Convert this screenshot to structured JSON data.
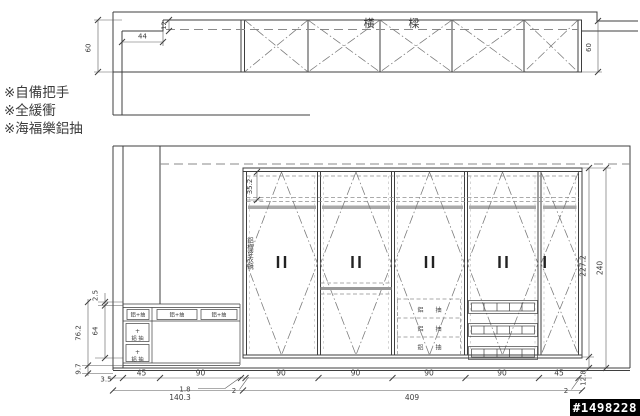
{
  "notes": [
    "※自備把手",
    "※全緩衝",
    "※海福樂鋁抽"
  ],
  "beam_plan": {
    "title": {
      "char1": "橫",
      "char2": "樑"
    },
    "dims": {
      "height_left": "60",
      "height_right": "60",
      "step_width": "44",
      "step_depth": "12"
    }
  },
  "elevation": {
    "dims": {
      "top_shelf_gap": "35.2",
      "body_height": "227.2",
      "total_height": "240",
      "kick_height": "12.8",
      "counter_thickness": "2.5",
      "drawer_col_height": "64",
      "bench_height": "76.2",
      "base_height": "9.7",
      "wall_thickness": "3.5",
      "widths": [
        "45",
        "90",
        "90",
        "90",
        "90",
        "90",
        "45"
      ],
      "filler_left": "1.8",
      "side_panel_left": "2",
      "side_panel_right": "2",
      "left_total": "140.3",
      "cabinet_total": "409"
    },
    "labels": {
      "mirror": "鋁框穿衣鏡",
      "alu_drawer_rows": [
        "鋁 抽",
        "鋁 抽",
        "鋁 抽"
      ],
      "bench_top_cells": [
        "鋁+抽",
        "鋁+抽",
        "鋁+抽"
      ],
      "bench_drawer_sign": "+",
      "bench_drawer_label": "鋁 抽"
    }
  },
  "watermark": "#1498228"
}
